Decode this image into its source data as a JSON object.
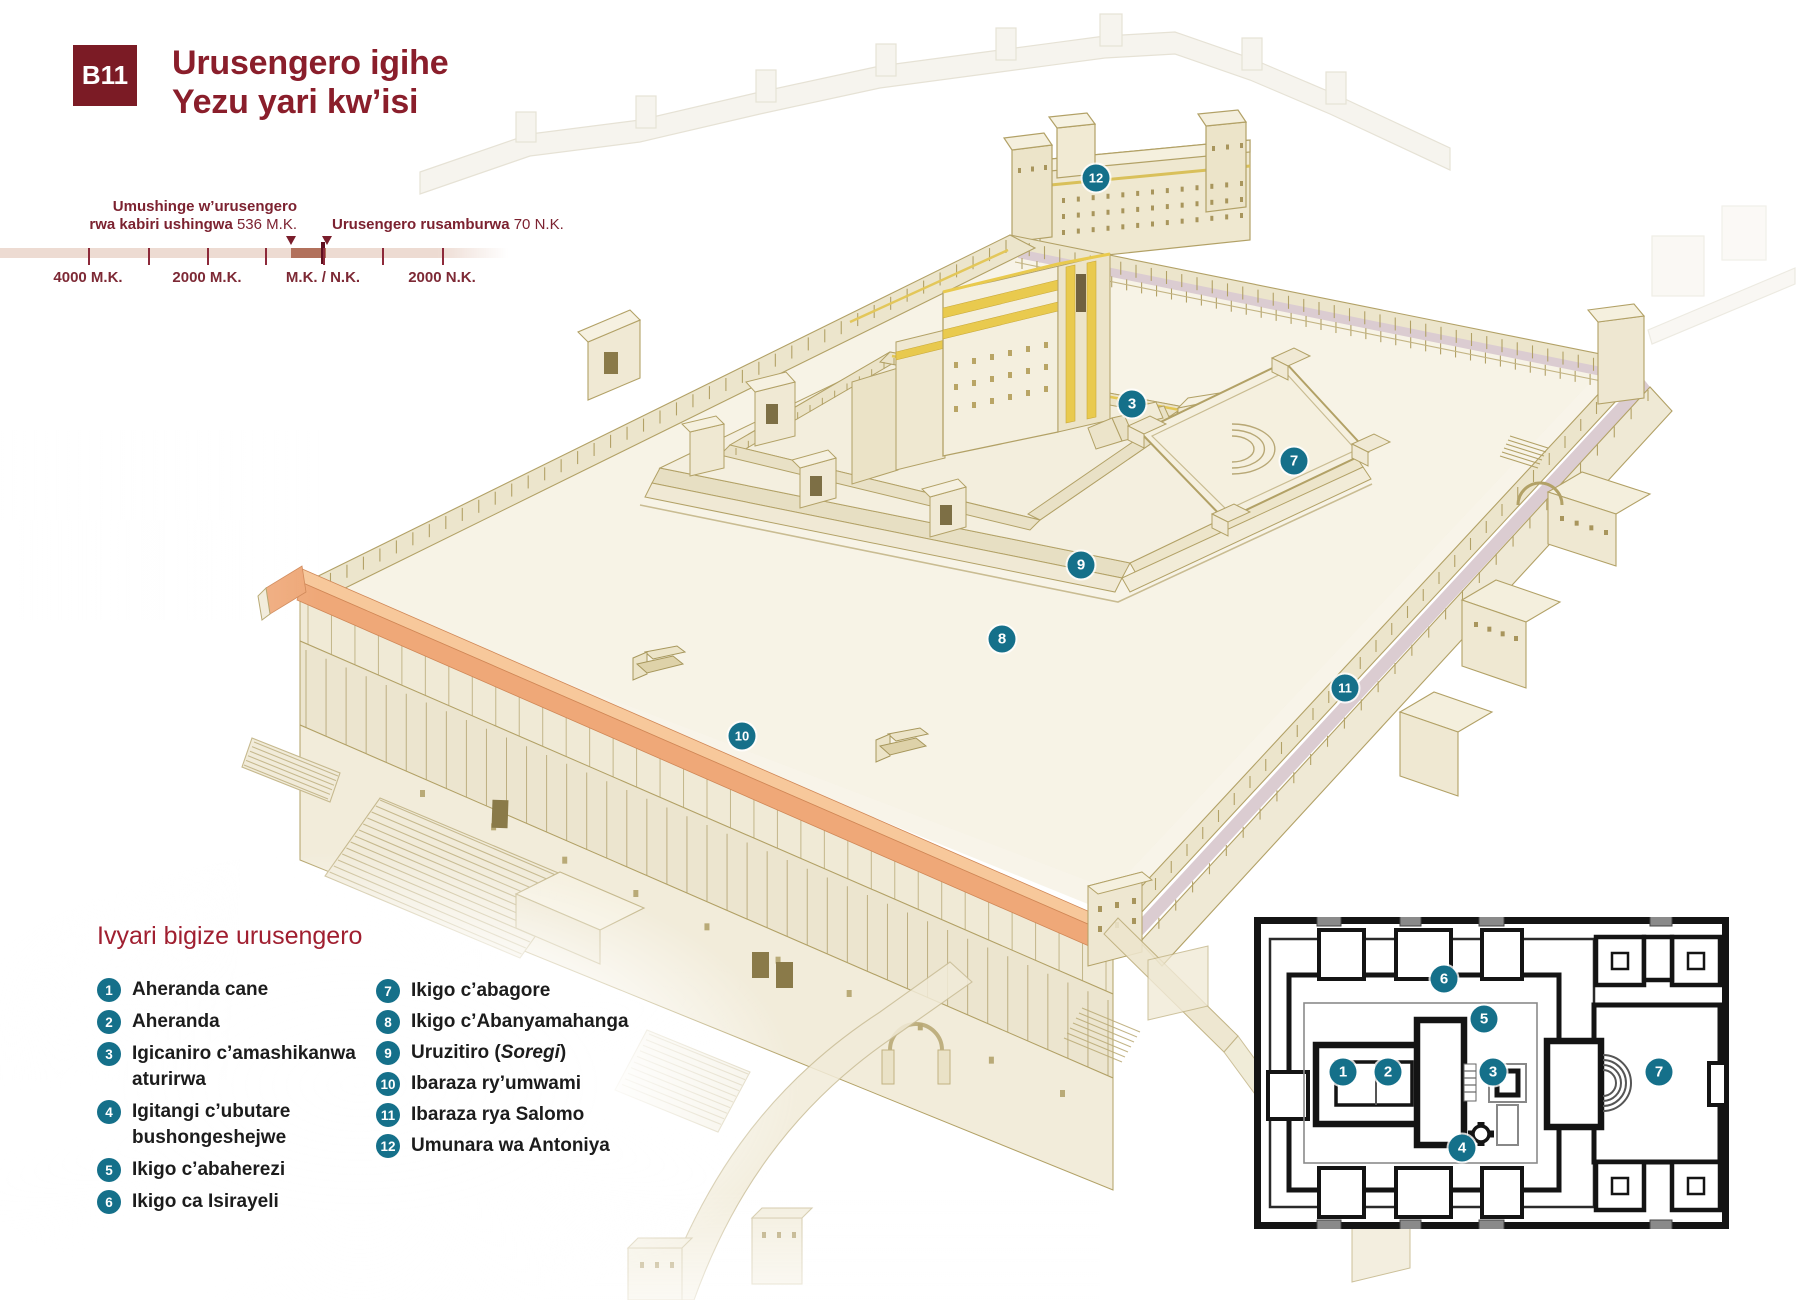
{
  "header": {
    "badge": "B11",
    "title_line1": "Urusengero igihe",
    "title_line2": "Yezu yari kw’isi"
  },
  "timeline": {
    "event1_line1": "Umushinge w’urusengero",
    "event1_line2_bold": "rwa kabiri ushingwa",
    "event1_value": "536 M.K.",
    "event2_bold": "Urusengero rusamburwa",
    "event2_value": "70 N.K.",
    "ticks": [
      {
        "x": 88,
        "label": "4000 M.K."
      },
      {
        "x": 148
      },
      {
        "x": 207,
        "label": "2000 M.K."
      },
      {
        "x": 265
      },
      {
        "x": 323,
        "label": "M.K. / N.K."
      },
      {
        "x": 382
      },
      {
        "x": 442,
        "label": "2000 N.K."
      }
    ],
    "marker1_x": 291,
    "marker2_x": 327
  },
  "legend": {
    "heading": "Ivyari bigize urusengero",
    "items_left": [
      {
        "num": "1",
        "label": "Aheranda cane"
      },
      {
        "num": "2",
        "label": "Aheranda"
      },
      {
        "num": "3",
        "label": "Igicaniro c’amashikanwa aturirwa"
      },
      {
        "num": "4",
        "label": "Igitangi c’ubutare bushongeshejwe"
      },
      {
        "num": "5",
        "label": "Ikigo c’abaherezi"
      },
      {
        "num": "6",
        "label": "Ikigo ca Isirayeli"
      }
    ],
    "items_right": [
      {
        "num": "7",
        "label": "Ikigo c’abagore"
      },
      {
        "num": "8",
        "label": "Ikigo c’Abanyamahanga"
      },
      {
        "num": "9",
        "label": "Uruzitiro (Soregi)",
        "italic": "Soregi"
      },
      {
        "num": "10",
        "label": "Ibaraza ry’umwami"
      },
      {
        "num": "11",
        "label": "Ibaraza rya Salomo"
      },
      {
        "num": "12",
        "label": "Umunara wa Antoniya"
      }
    ]
  },
  "illustration_markers": [
    {
      "num": "3",
      "x": 1132,
      "y": 404
    },
    {
      "num": "7",
      "x": 1294,
      "y": 461
    },
    {
      "num": "8",
      "x": 1002,
      "y": 639
    },
    {
      "num": "9",
      "x": 1081,
      "y": 565
    },
    {
      "num": "10",
      "x": 742,
      "y": 736
    },
    {
      "num": "11",
      "x": 1345,
      "y": 688
    },
    {
      "num": "12",
      "x": 1096,
      "y": 178
    }
  ],
  "floorplan_markers": [
    {
      "num": "1",
      "x": 89,
      "y": 155
    },
    {
      "num": "2",
      "x": 134,
      "y": 155
    },
    {
      "num": "3",
      "x": 239,
      "y": 155
    },
    {
      "num": "4",
      "x": 208,
      "y": 231
    },
    {
      "num": "5",
      "x": 230,
      "y": 102
    },
    {
      "num": "6",
      "x": 190,
      "y": 62
    },
    {
      "num": "7",
      "x": 405,
      "y": 155
    }
  ],
  "colors": {
    "accent_teal": "#15708a",
    "badge_maroon": "#7b1b25",
    "title_red": "#8a1e2b",
    "timeline_bar": "#eddbd2",
    "timeline_highlight": "#b2715c",
    "roof_orange": "#efa878",
    "gold": "#e8c94e"
  }
}
